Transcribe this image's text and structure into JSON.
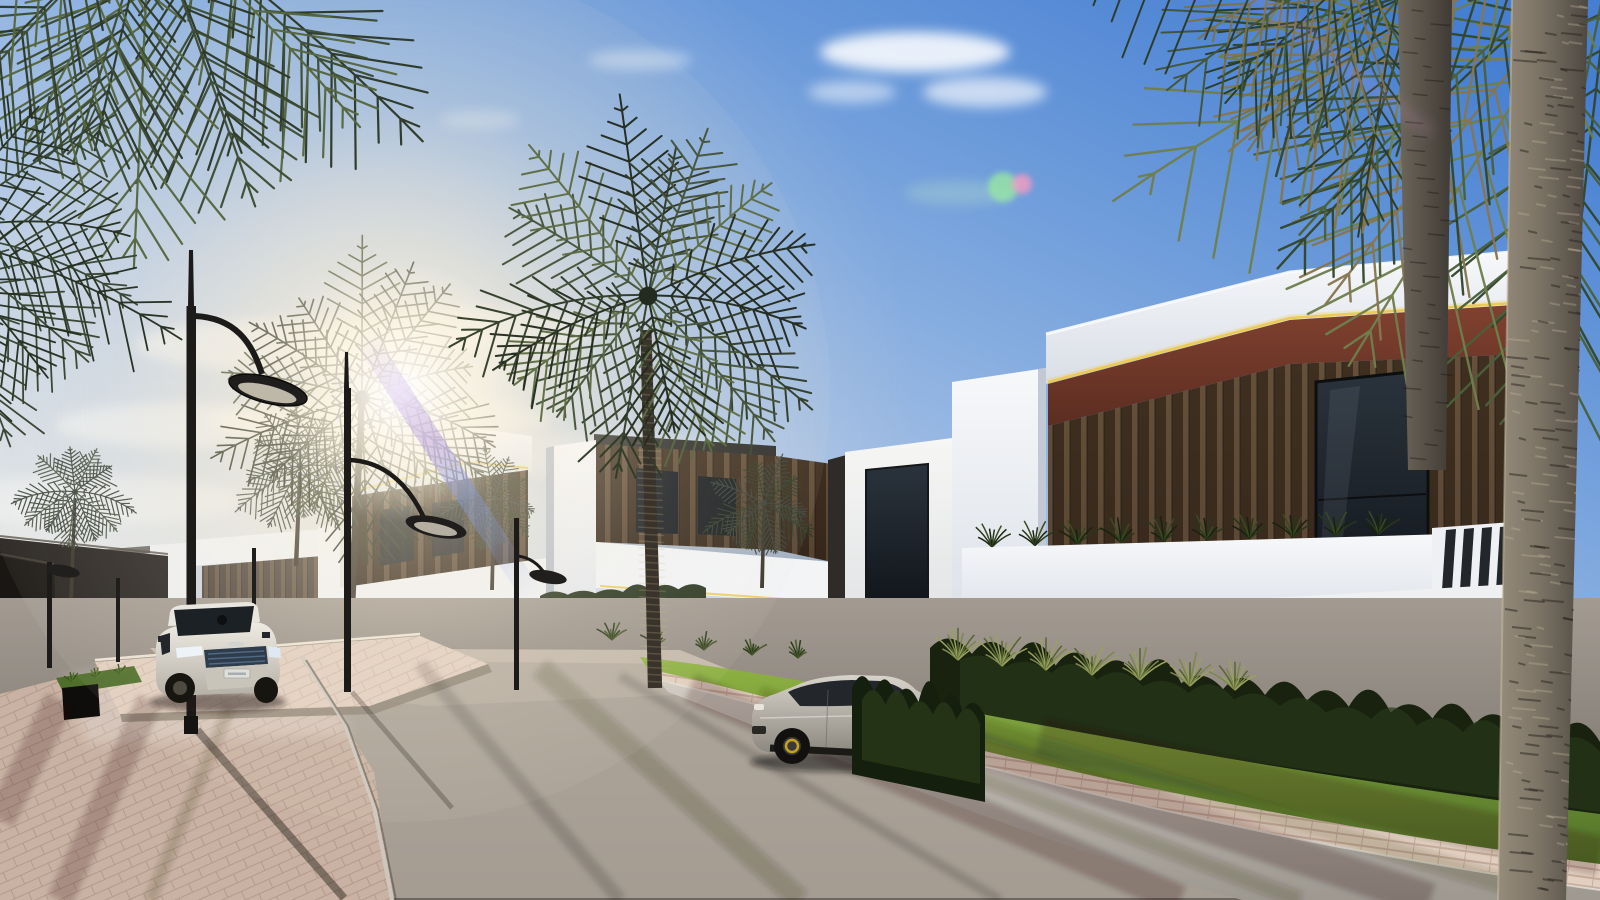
{
  "scene": {
    "type": "3d-architectural-exterior-render",
    "description": "Sunlit street through a modern villa community lined with date palms",
    "inventory": {
      "sky": [
        "blue gradient sky",
        "wispy white clouds",
        "sun glare behind palm",
        "purple lens streak",
        "green-pink lens flare"
      ],
      "buildings": [
        "receding row of white villas with timber slat cladding",
        "two-storey villa mid-street",
        "large corner villa with red fascia, gold LED trim, balcony planting, stone and glass ground floor"
      ],
      "vehicles": [
        "white luxury SUV driving toward camera",
        "silver sports SUV parked at kerb"
      ],
      "vegetation": [
        "overhanging palm canopies",
        "tall palm trunks",
        "clipped dark hedges",
        "ornamental grasses",
        "sunlit lawn strip"
      ],
      "street": [
        "asphalt roadway with long shadows",
        "pink paver sidewalks",
        "raised paver terrace",
        "black stone planter walls",
        "curved-arm street lamps",
        "concrete kerbs"
      ]
    }
  },
  "palette": {
    "sky_top": "#467fd2",
    "sky_mid": "#7da7de",
    "sky_low": "#b6cbe8",
    "sky_warm": "#e4e7e9",
    "cloud": "#ffffff",
    "sun_core": "#fff9ec",
    "sun_halo": "#fdeecb",
    "flare_purple": "#a98ae2",
    "flare_blue": "#87a2ea",
    "flare_green": "#97e6a4",
    "flare_pink": "#ff9cc2",
    "frond_black": "#20261c",
    "frond_black2": "#2c3424",
    "frond_dark": "#232a1e",
    "frond_mid": "#323d28",
    "frond_olive": "#46543a",
    "frond_light": "#5e6c44",
    "frond_deep": "#33462d",
    "frond_green": "#49603a",
    "frond_sun": "#6e7e4c",
    "frond_dry": "#86764f",
    "frond_blue": "#39423a",
    "frond_blue2": "#4a5446",
    "trunk_dark": "#39332b",
    "trunk_light": "#968c7c",
    "trunk_shade": "#4e4841",
    "trunk2_light": "#6e675c",
    "trunk2_shade": "#3f3a34",
    "wood_dark": "#3f2f20",
    "wood_mid": "#66503a",
    "wood_light": "#8a6e4e",
    "fascia_top": "#81422f",
    "fascia_bot": "#5c2d22",
    "led_gold": "#ecc94e",
    "glass_top": "#2a333c",
    "glass_bot": "#10141a",
    "stone_tile": "#9aa29a",
    "stone_dark": "#413e38",
    "wall_black": "#191613",
    "wall_dark": "#262220",
    "wall_top": "#f7f8fa",
    "wall_bot": "#d9dee6",
    "wall_cool": "#c7ccd7",
    "wall_shade": "#b9bfca",
    "road_top": "#a39b92",
    "road_mid": "#8b847c",
    "road_bot": "#6c665f",
    "road_sun": "#c6bcae",
    "paver_pink": "#c9b2a3",
    "paver_bright": "#e2cfc0",
    "curb_top": "#cfcac2",
    "curb_bot": "#9d9890",
    "grass_top": "#90b443",
    "grass_bot": "#507028",
    "grass_left": "#4f6e2b",
    "hedge_dark": "#18220f",
    "hedge_mid": "#27371a",
    "plant_olive": "#7c874d",
    "plant_light": "#9aa05e",
    "plant_deep": "#55652f",
    "car_white_top": "#efece4",
    "car_white_bot": "#b5b0a6",
    "car_silver_top": "#d8d4cc",
    "car_silver_bot": "#8b877f",
    "caliper_yellow": "#c9a922",
    "lamp_black": "#1c1b19"
  }
}
